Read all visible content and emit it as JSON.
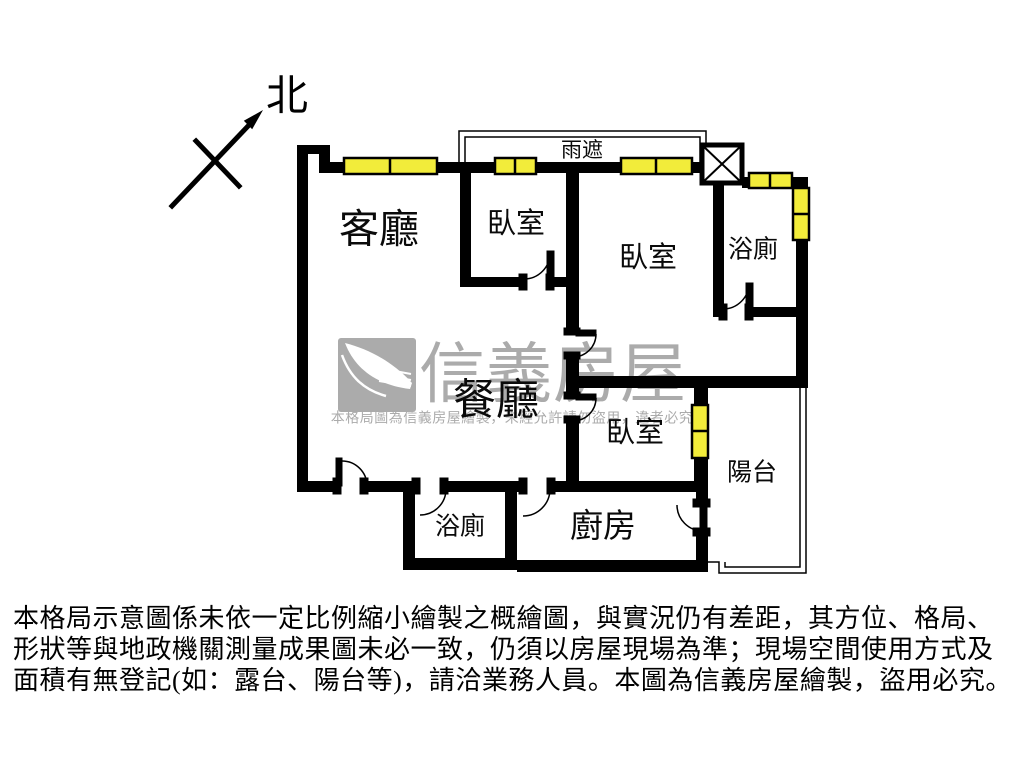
{
  "compass": {
    "label": "北"
  },
  "plan": {
    "canopy_label": "雨遮",
    "rooms": {
      "living": "客廳",
      "bedroom_top": "臥室",
      "bedroom_right": "臥室",
      "bedroom_lower": "臥室",
      "bath_upper": "浴廁",
      "bath_lower": "浴廁",
      "dining": "餐廳",
      "kitchen": "廚房",
      "balcony": "陽台"
    },
    "colors": {
      "wall": "#000000",
      "window": "#f2ec3a",
      "watermark": "#ababab"
    }
  },
  "watermark": {
    "brand": "信義房屋",
    "notice": "本格局圖為信義房屋繪製，未經允許請勿盜用，違者必究"
  },
  "disclaimer": {
    "line1": "本格局示意圖係未依一定比例縮小繪製之概繪圖，與實況仍有差距，其方位、格局、",
    "line2": "形狀等與地政機關測量成果圖未必一致，仍須以房屋現場為準；現場空間使用方式及",
    "line3": "面積有無登記(如：露台、陽台等)，請洽業務人員。本圖為信義房屋繪製，盜用必究。"
  }
}
